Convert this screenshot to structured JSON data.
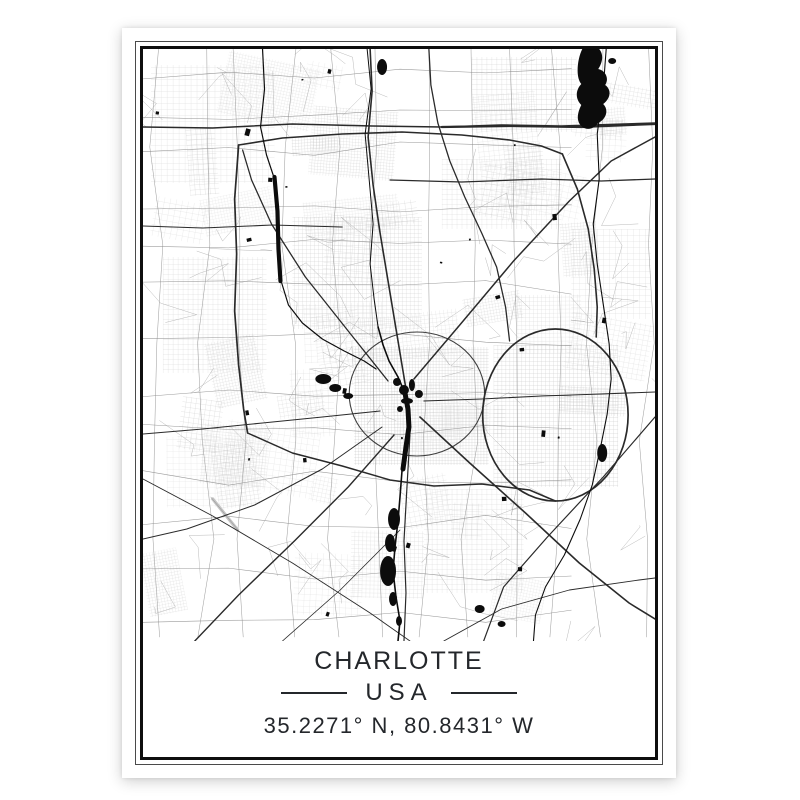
{
  "poster": {
    "title": "CHARLOTTE",
    "country": "USA",
    "coordinates": "35.2271° N, 80.8431° W",
    "text_color": "#24272b",
    "frame_color": "#0e0e0e",
    "thin_frame_color": "#4a4a4a"
  },
  "map": {
    "background": "#ffffff",
    "ink_black": "#0c0c0c",
    "road_major": "#2a2a2a",
    "road_medium": "#8a8a8a",
    "road_minor": "#a4a4a4",
    "grid_line": "#b8b8b8",
    "runway_gray": "#c4c4c4"
  }
}
